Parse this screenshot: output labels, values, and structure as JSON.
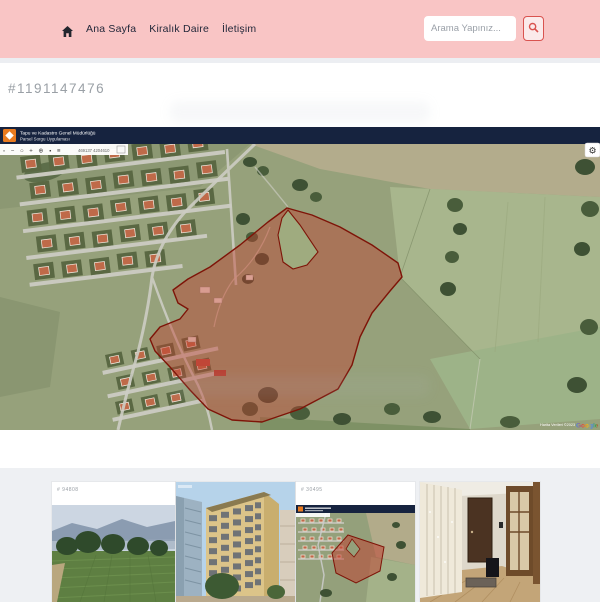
{
  "topbar": {
    "background": "#f9c5c5",
    "nav_items": [
      {
        "label": "Ana Sayfa"
      },
      {
        "label": "Kiralık Daire"
      },
      {
        "label": "İletişim"
      }
    ],
    "search": {
      "placeholder": "Arama Yapınız...",
      "button_color": "#d9534f"
    }
  },
  "listing": {
    "id": "#1191147476"
  },
  "map": {
    "header": {
      "line1": "Tapu ve Kadastro Genel Müdürlüğü",
      "line2": "Parsel Sorgu Uygulaması"
    },
    "toolbar": {
      "icon_names": [
        "select",
        "zoom-out",
        "refresh",
        "zoom-in",
        "locate",
        "marker",
        "layers"
      ],
      "icons_glyphs": "▫ − ○ + ⊕ ▪ ≡",
      "coordinates": "469137  4204610"
    },
    "attribution": {
      "text": "Harita Verileri ©2023",
      "brand": "Google"
    },
    "parcel": {
      "fill": "rgba(192,57,43,0.42)",
      "stroke": "#7e1408"
    },
    "header_colors": {
      "bar": "#16233f",
      "logo": "#e87a1f"
    }
  },
  "icons": {
    "gear": "⚙",
    "home": "⌂"
  },
  "thumbnails": [
    {
      "id": "# 94808",
      "name": "field-photo"
    },
    {
      "id": "",
      "name": "building-photo"
    },
    {
      "id": "# 30495",
      "name": "parcel-map-photo"
    },
    {
      "id": "",
      "name": "interior-photo"
    }
  ]
}
